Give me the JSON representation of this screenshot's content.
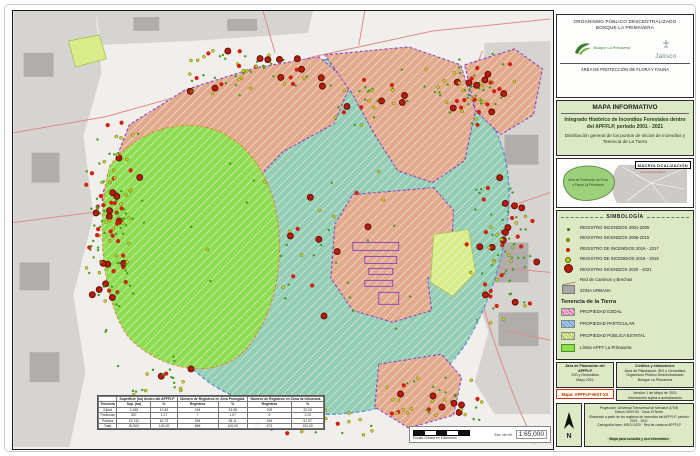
{
  "header": {
    "org_line1": "ORGANISMO PÚBLICO DESCENTRALIZADO",
    "org_line2": "BOSQUE LA PRIMAVERA",
    "logo_left": "Bosque La Primavera",
    "logo_right": "Jalisco",
    "subtitle": "ÁREA DE PROTECCIÓN DE FLORA Y FAUNA"
  },
  "title_block": {
    "title": "MAPA INFORMATIVO",
    "line1": "Integrado Histórico de Incendios Forestales dentro del APFFLP, periodo 2001 - 2021",
    "line2": "Distribución general de los puntos de inicios de incendios y Tenencia de La Tierra"
  },
  "macro": {
    "label": "MACROLOCALIZACIÓN",
    "apff_label_1": "Área de Protección de Flora",
    "apff_label_2": "y Fauna La Primavera",
    "metro_label": "Área Metropolitana de Guadalajara"
  },
  "legend": {
    "title": "SIMBOLOGÍA",
    "items": [
      "REGISTRO INCENDIOS 2001-2005",
      "REGISTRO INCENDIOS 2006-2015",
      "REGISTRO DE INCENDIOS 2016 - 2017",
      "REGISTRO DE INCENDIOS 2018 - 2019",
      "REGISTRO INCENDIOS 2020 - 2021",
      "Red de Caminos y Brechas",
      "ZONA URBANA"
    ],
    "tenencia_title": "Tenencia de la Tierra",
    "tenencia_items": [
      "PROPIEDAD EJIDAL",
      "PROPIEDAD PARTICULAR",
      "PROPIEDAD PÚBLICA ESTATAL",
      "Límite APFF La Primavera"
    ]
  },
  "credits": {
    "left": [
      "Área de Planeación del APFFLP",
      "SIG y Geomática",
      "Mayo 2021"
    ],
    "right_top": [
      "Créditos y elaboración:",
      "Área de Planeación, SIG y Geomática",
      "Organismo Público Descentralizado",
      "Bosque La Primavera"
    ],
    "right_bottom": [
      "Versión 1 de Mayo de 2021",
      "Información sujeta a actualización"
    ],
    "map_code": "Mapa: APFFLP-HIST-XX",
    "north_label": "N",
    "projection_lines": [
      "Proyección: Universal Transversal de Mercator (UTM)",
      "Datum: WGS 84 · Zona 13 Norte",
      "Elaborado a partir de los registros de incendios del APFFLP, periodo 2001 - 2021",
      "Cartografía base: INEGI 2020 · Red de caminos APFFLP",
      "Mapa para consulta y uso informativo"
    ]
  },
  "map": {
    "scale_caption": "Escala Gráfica en Kilómetros",
    "scale_ref_label": "Esc. de ref.",
    "scale_value": "1:65,000",
    "table": {
      "group_headers": [
        "Superficie (ha) dentro del APFFLP",
        "Número de Registros en Área Protegida",
        "Número de Registros en Zona de Influencia"
      ],
      "sub_headers": [
        "Tenencia",
        "Sup. (ha)",
        "%",
        "Registros",
        "%",
        "Registros",
        "%"
      ],
      "rows": [
        [
          "Ejidal",
          "3,188",
          "10.45",
          "154",
          "23.08",
          "105",
          "22.15"
        ],
        [
          "Particular",
          "357",
          "1.17",
          "7",
          "1.07",
          "6",
          "1.24"
        ],
        [
          "Pública",
          "19,132",
          "62.73",
          "254",
          "38.11",
          "246",
          "51.97"
        ],
        [
          "Total",
          "30,500",
          "100.00",
          "668",
          "100.00",
          "473",
          "100.00"
        ]
      ]
    },
    "dot_mix": {
      "green": 0.45,
      "yellow": 0.25,
      "red": 0.18,
      "bigred": 0.12
    },
    "dot_clusters": [
      {
        "x": 100,
        "y": 215,
        "rx": 32,
        "ry": 120,
        "n": 130
      },
      {
        "x": 235,
        "y": 62,
        "rx": 90,
        "ry": 30,
        "n": 60
      },
      {
        "x": 355,
        "y": 88,
        "rx": 55,
        "ry": 32,
        "n": 30
      },
      {
        "x": 462,
        "y": 78,
        "rx": 58,
        "ry": 42,
        "n": 65
      },
      {
        "x": 492,
        "y": 240,
        "rx": 42,
        "ry": 78,
        "n": 85
      },
      {
        "x": 425,
        "y": 392,
        "rx": 65,
        "ry": 28,
        "n": 40
      },
      {
        "x": 300,
        "y": 412,
        "rx": 75,
        "ry": 18,
        "n": 25
      },
      {
        "x": 300,
        "y": 230,
        "rx": 130,
        "ry": 105,
        "n": 40
      },
      {
        "x": 145,
        "y": 368,
        "rx": 48,
        "ry": 30,
        "n": 22
      }
    ]
  },
  "colors": {
    "panel_bg": "#dde8c5",
    "teal": "#93cdb4",
    "lime": "#8edc52",
    "salmon": "#e2aa8c",
    "public_yellow": "#d9ec8a",
    "urban_light": "#d6d4d1",
    "urban_dark": "#a9a7a3",
    "road": "#e08a8a",
    "purple": "#8a3fc0",
    "dot_green": "#3f9b1e",
    "dot_yellow": "#d6d11e",
    "dot_red": "#d02010",
    "dot_bigred": "#b51d0b"
  }
}
